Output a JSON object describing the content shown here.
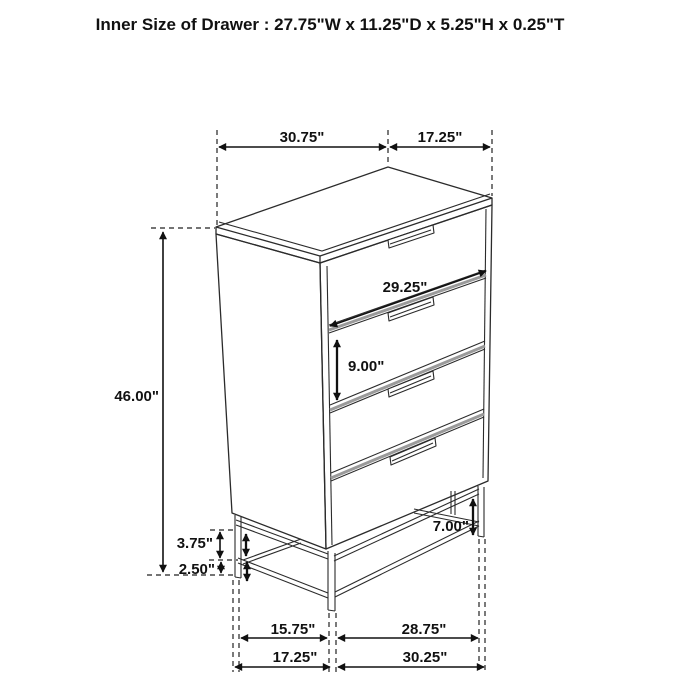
{
  "title": "Inner Size of Drawer : 27.75\"W x 11.25\"D x 5.25\"H x 0.25\"T",
  "dims": {
    "top_width": "30.75\"",
    "top_depth": "17.25\"",
    "overall_height": "46.00\"",
    "drawer_front_width": "29.25\"",
    "drawer_front_height": "9.00\"",
    "base_frame_height": "3.75\"",
    "foot_height": "2.50\"",
    "base_clearance": "7.00\"",
    "base_inner_depth": "15.75\"",
    "base_inner_width": "28.75\"",
    "base_outer_depth": "17.25\"",
    "base_outer_width": "30.25\""
  },
  "colors": {
    "line": "#2b2b2b",
    "dimension": "#111111",
    "gap_shading": "#9a9a9a",
    "background": "#ffffff"
  }
}
